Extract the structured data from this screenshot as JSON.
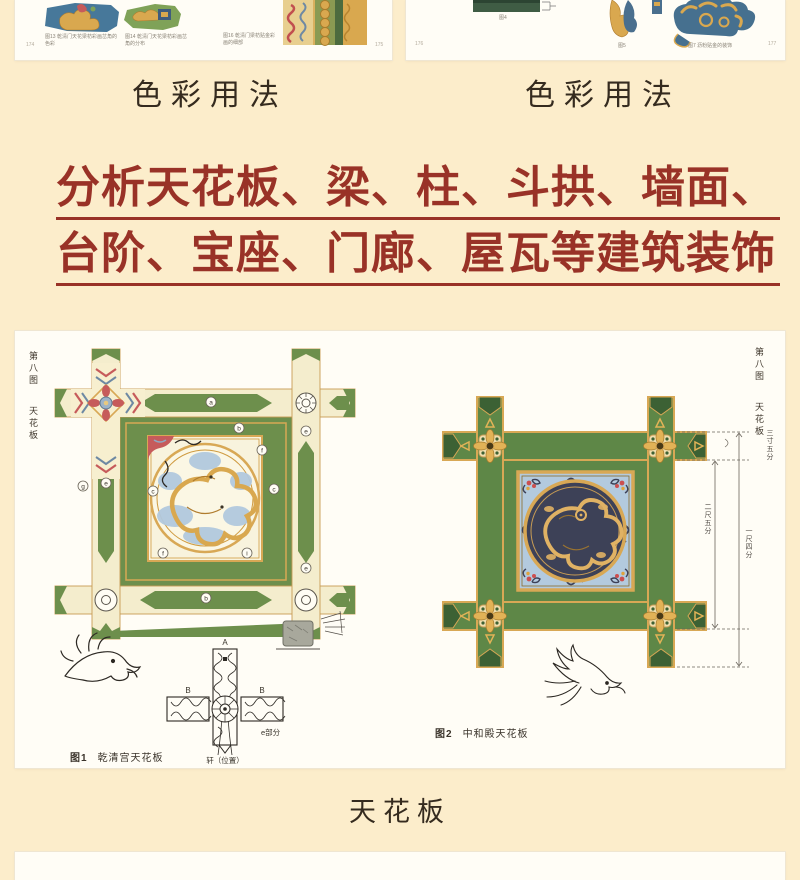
{
  "colors": {
    "background": "#fcedcb",
    "card": "#fffdf6",
    "headline_red": "#993227",
    "panel_green": "#6d8f4c",
    "beam_cream": "#f4edcd",
    "gold": "#d8a855",
    "light_blue": "#aac5dd",
    "navy": "#3d4157",
    "ink": "#2d2924"
  },
  "top_left_page": {
    "title": "色彩用法",
    "figure_captions": [
      "图13 乾清门天花梁枋彩画岔角的色彩",
      "图14 乾清门天花梁枋彩画岔角的分布",
      "图16 乾清门梁枋贴金彩画的细部"
    ],
    "page_numbers": [
      "174",
      "175"
    ]
  },
  "top_right_page": {
    "title": "色彩用法",
    "figure_captions": [
      "图4",
      "图5",
      "图7 沥粉贴金的装饰"
    ],
    "page_numbers": [
      "176",
      "177"
    ]
  },
  "headline": {
    "line1": "分析天花板、梁、柱、斗拱、墙面、",
    "line2": "台阶、宝座、门廊、屋瓦等建筑装饰"
  },
  "spread": {
    "margin_label_top": "第八图",
    "margin_label_bottom": "天花板",
    "figure1": {
      "no": "图1",
      "caption": "乾清宫天花板",
      "label_a": "A",
      "label_b_left": "B",
      "label_b_right": "B",
      "label_part": "e部分",
      "label_pos": "轩（位置）",
      "callouts": [
        "a",
        "b",
        "f",
        "g",
        "e",
        "c",
        "c",
        "f",
        "i",
        "b",
        "e",
        "e"
      ]
    },
    "figure2": {
      "no": "图2",
      "caption": "中和殿天花板",
      "dim_top": "三寸五分",
      "dim_inner": "二尺五分",
      "dim_outer": "一尺四分"
    }
  },
  "bottom_title": "天花板"
}
